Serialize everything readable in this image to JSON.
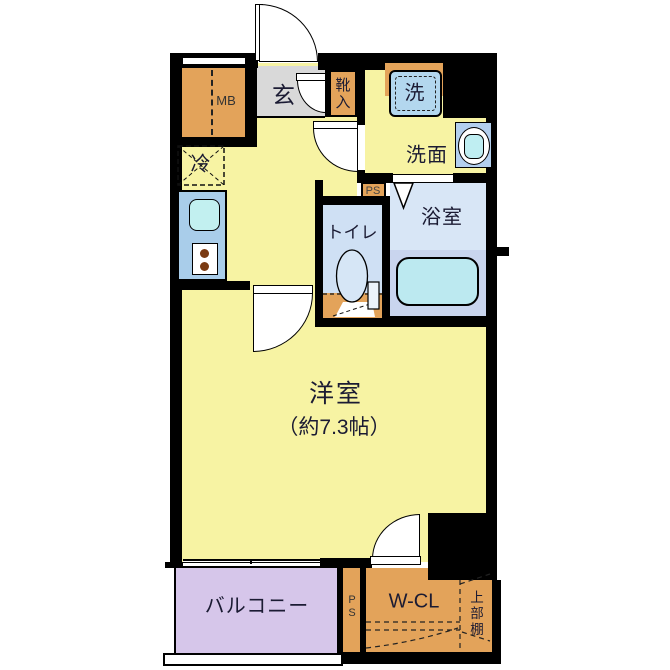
{
  "floor_plan": {
    "type": "apartment-floor-plan",
    "labels": {
      "entrance": "玄",
      "shoe_cabinet": "靴入",
      "washer": "洗",
      "washroom": "洗面",
      "bathroom": "浴室",
      "toilet": "トイレ",
      "refrigerator": "冷",
      "meter_box": "MB",
      "pipe_space_top": "PS",
      "pipe_space_bottom": "PS",
      "western_room": "洋室",
      "western_room_size": "（約7.3帖）",
      "balcony": "バルコニー",
      "walk_in_closet": "W-CL",
      "upper_shelf": "上部棚"
    },
    "colors": {
      "room_yellow": "#f7f3a3",
      "storage_orange": "#e3a35a",
      "entrance_gray": "#d9d9d9",
      "kitchen_counter_blue": "#a9cdea",
      "sink_cyan": "#c2f0f0",
      "toilet_room_blue": "#cfe0f4",
      "bathroom_blue_upper": "#d8e6f6",
      "bathroom_blue_lower": "#c9d5ee",
      "bathtub_cyan": "#bce9f0",
      "washer_pan_blue": "#b3d7ee",
      "balcony_lavender": "#d6c6ea",
      "wall_black": "#000000",
      "background": "#ffffff"
    }
  }
}
